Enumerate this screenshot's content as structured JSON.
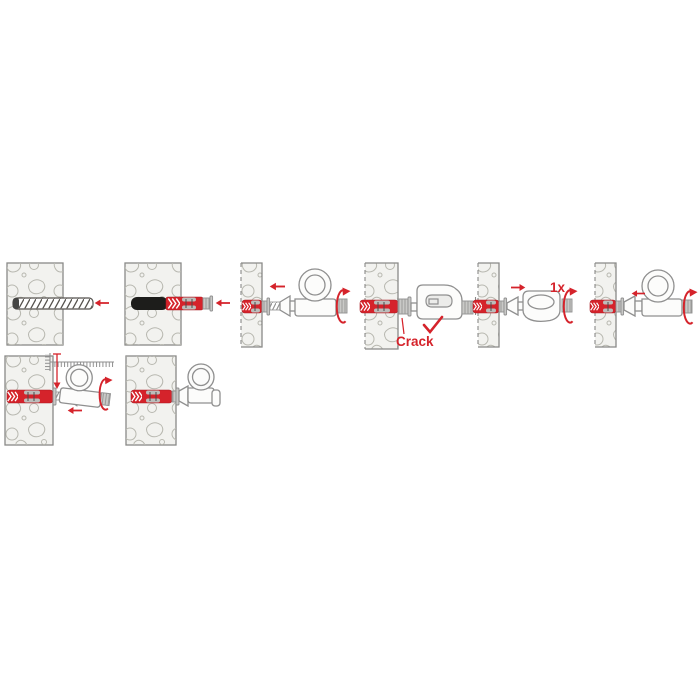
{
  "diagram": {
    "labels": {
      "crack": "Crack",
      "one_turn": "1x"
    },
    "colors": {
      "accent_red": "#d5232b",
      "outline_gray": "#8f8f8f",
      "concrete_fill": "#f2f2ef",
      "stone_outline": "#b8b8b0",
      "metal_black": "#1d1d1b",
      "hardware_gray": "#c9c9c7"
    },
    "panels": [
      {
        "step": 1,
        "row": 1,
        "icons": [
          "concrete-wall",
          "drill-bit-icon",
          "arrow-left-icon"
        ]
      },
      {
        "step": 2,
        "row": 1,
        "icons": [
          "concrete-wall",
          "anchor-plug-icon",
          "arrow-left-icon"
        ]
      },
      {
        "step": 3,
        "row": 1,
        "icons": [
          "wall-section",
          "anchor-plug-icon",
          "screw-thread-icon",
          "eye-hook-icon",
          "arrow-left-icon",
          "rotation-arrow-icon"
        ]
      },
      {
        "step": 4,
        "row": 1,
        "icons": [
          "wall-section",
          "anchor-plug-icon",
          "eye-hook-icon",
          "checkmark-icon"
        ],
        "label": "Crack"
      },
      {
        "step": 5,
        "row": 1,
        "icons": [
          "wall-section",
          "anchor-plug-icon",
          "eye-hook-icon",
          "arrow-right-icon",
          "rotation-arrow-icon"
        ],
        "label": "1x"
      },
      {
        "step": 6,
        "row": 1,
        "icons": [
          "wall-section",
          "anchor-plug-icon",
          "eye-hook-icon",
          "arrow-left-icon",
          "rotation-arrow-icon"
        ]
      },
      {
        "step": 7,
        "row": 2,
        "icons": [
          "concrete-wall",
          "anchor-plug-icon",
          "depth-ruler-icon",
          "screw-thread-icon",
          "eye-hook-icon",
          "rotation-arrow-icon",
          "arrow-left-icon"
        ]
      },
      {
        "step": 8,
        "row": 2,
        "icons": [
          "concrete-wall",
          "anchor-plug-icon",
          "eye-hook-icon"
        ]
      }
    ]
  }
}
